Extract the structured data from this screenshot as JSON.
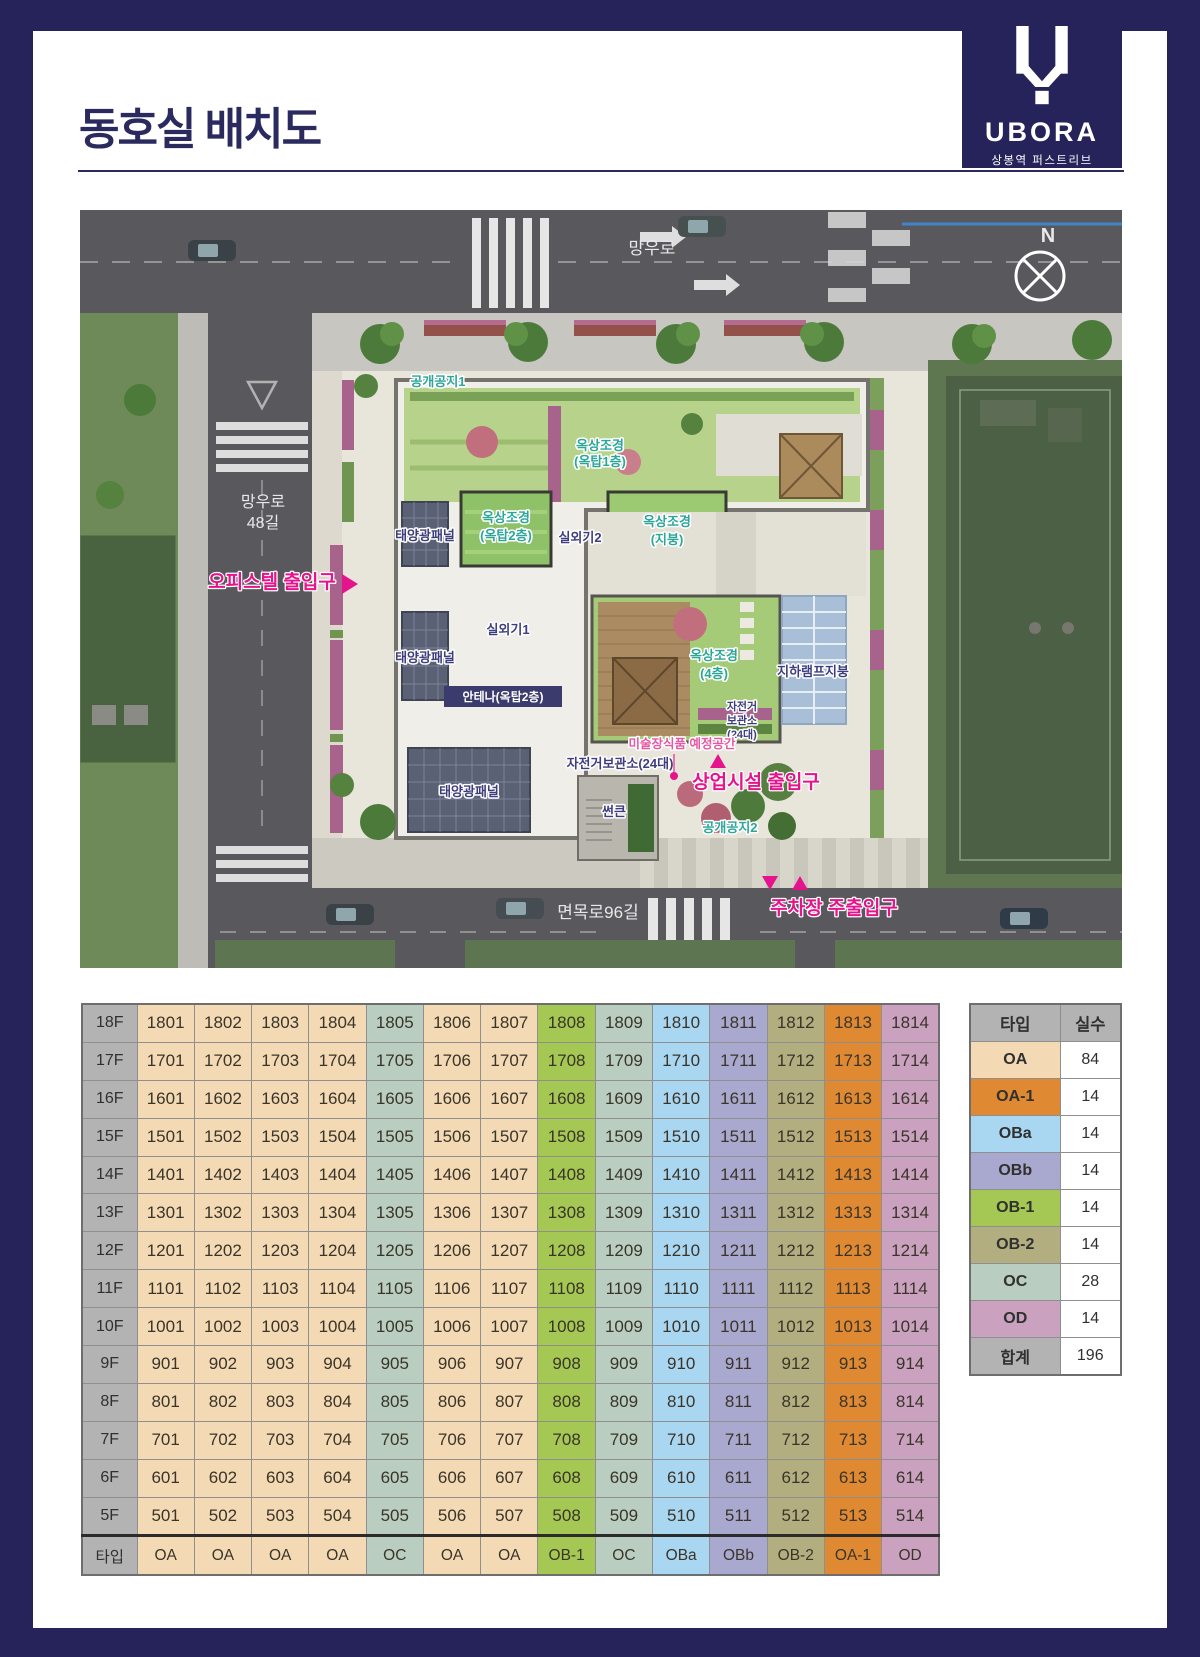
{
  "header": {
    "title": "동호실 배치도"
  },
  "logo": {
    "brand": "UBORA",
    "subtitle": "상봉역 퍼스트리브"
  },
  "map": {
    "road_top": "망우로",
    "road_left_1": "망우로",
    "road_left_2": "48길",
    "road_bottom": "면목로96길",
    "compass": "N",
    "labels": {
      "public1": "공개공지1",
      "roofgarden_top_l1": "옥상조경",
      "roofgarden_top_l2": "(옥탑1층)",
      "solar1": "태양광패널",
      "solar2": "태양광패널",
      "solar3": "태양광패널",
      "roofgarden2_l1": "옥상조경",
      "roofgarden2_l2": "(옥탑2층)",
      "ac2": "실외기2",
      "roofgarden_roof_l1": "옥상조경",
      "roofgarden_roof_l2": "(지붕)",
      "ac1": "실외기1",
      "antenna": "안테나(옥탑2층)",
      "roofgarden4_l1": "옥상조경",
      "roofgarden4_l2": "(4층)",
      "ramp_roof": "지하램프지붕",
      "art_space": "미술장식품 예정공간",
      "bike1": "자전거보관소(24대)",
      "bike2_l1": "자전거",
      "bike2_l2": "보관소",
      "bike2_l3": "(24대)",
      "sunken": "썬큰",
      "public2": "공개공지2",
      "entrance_officetel": "오피스텔 출입구",
      "entrance_retail": "상업시설 출입구",
      "entrance_parking": "주차장 주출입구"
    }
  },
  "table": {
    "type_header_label": "타입",
    "column_types": [
      "OA",
      "OA",
      "OA",
      "OA",
      "OC",
      "OA",
      "OA",
      "OB-1",
      "OC",
      "OBa",
      "OBb",
      "OB-2",
      "OA-1",
      "OD"
    ],
    "floors": [
      {
        "label": "18F",
        "units": [
          "1801",
          "1802",
          "1803",
          "1804",
          "1805",
          "1806",
          "1807",
          "1808",
          "1809",
          "1810",
          "1811",
          "1812",
          "1813",
          "1814"
        ]
      },
      {
        "label": "17F",
        "units": [
          "1701",
          "1702",
          "1703",
          "1704",
          "1705",
          "1706",
          "1707",
          "1708",
          "1709",
          "1710",
          "1711",
          "1712",
          "1713",
          "1714"
        ]
      },
      {
        "label": "16F",
        "units": [
          "1601",
          "1602",
          "1603",
          "1604",
          "1605",
          "1606",
          "1607",
          "1608",
          "1609",
          "1610",
          "1611",
          "1612",
          "1613",
          "1614"
        ]
      },
      {
        "label": "15F",
        "units": [
          "1501",
          "1502",
          "1503",
          "1504",
          "1505",
          "1506",
          "1507",
          "1508",
          "1509",
          "1510",
          "1511",
          "1512",
          "1513",
          "1514"
        ]
      },
      {
        "label": "14F",
        "units": [
          "1401",
          "1402",
          "1403",
          "1404",
          "1405",
          "1406",
          "1407",
          "1408",
          "1409",
          "1410",
          "1411",
          "1412",
          "1413",
          "1414"
        ]
      },
      {
        "label": "13F",
        "units": [
          "1301",
          "1302",
          "1303",
          "1304",
          "1305",
          "1306",
          "1307",
          "1308",
          "1309",
          "1310",
          "1311",
          "1312",
          "1313",
          "1314"
        ]
      },
      {
        "label": "12F",
        "units": [
          "1201",
          "1202",
          "1203",
          "1204",
          "1205",
          "1206",
          "1207",
          "1208",
          "1209",
          "1210",
          "1211",
          "1212",
          "1213",
          "1214"
        ]
      },
      {
        "label": "11F",
        "units": [
          "1101",
          "1102",
          "1103",
          "1104",
          "1105",
          "1106",
          "1107",
          "1108",
          "1109",
          "1110",
          "1111",
          "1112",
          "1113",
          "1114"
        ]
      },
      {
        "label": "10F",
        "units": [
          "1001",
          "1002",
          "1003",
          "1004",
          "1005",
          "1006",
          "1007",
          "1008",
          "1009",
          "1010",
          "1011",
          "1012",
          "1013",
          "1014"
        ]
      },
      {
        "label": "9F",
        "units": [
          "901",
          "902",
          "903",
          "904",
          "905",
          "906",
          "907",
          "908",
          "909",
          "910",
          "911",
          "912",
          "913",
          "914"
        ]
      },
      {
        "label": "8F",
        "units": [
          "801",
          "802",
          "803",
          "804",
          "805",
          "806",
          "807",
          "808",
          "809",
          "810",
          "811",
          "812",
          "813",
          "814"
        ]
      },
      {
        "label": "7F",
        "units": [
          "701",
          "702",
          "703",
          "704",
          "705",
          "706",
          "707",
          "708",
          "709",
          "710",
          "711",
          "712",
          "713",
          "714"
        ]
      },
      {
        "label": "6F",
        "units": [
          "601",
          "602",
          "603",
          "604",
          "605",
          "606",
          "607",
          "608",
          "609",
          "610",
          "611",
          "612",
          "613",
          "614"
        ]
      },
      {
        "label": "5F",
        "units": [
          "501",
          "502",
          "503",
          "504",
          "505",
          "506",
          "507",
          "508",
          "509",
          "510",
          "511",
          "512",
          "513",
          "514"
        ]
      }
    ]
  },
  "legend": {
    "headers": [
      "타입",
      "실수"
    ],
    "rows": [
      {
        "type": "OA",
        "count": "84"
      },
      {
        "type": "OA-1",
        "count": "14"
      },
      {
        "type": "OBa",
        "count": "14"
      },
      {
        "type": "OBb",
        "count": "14"
      },
      {
        "type": "OB-1",
        "count": "14"
      },
      {
        "type": "OB-2",
        "count": "14"
      },
      {
        "type": "OC",
        "count": "28"
      },
      {
        "type": "OD",
        "count": "14"
      },
      {
        "type": "합계",
        "count": "196"
      }
    ]
  },
  "colors": {
    "frame_navy": "#26225a",
    "title_navy": "#2b2a5e",
    "header_gray": "#b3b3b3",
    "types": {
      "OA": "#f3dab4",
      "OA-1": "#df8a33",
      "OBa": "#a9d7f2",
      "OBb": "#a9a8cf",
      "OB-1": "#a5c854",
      "OB-2": "#b2ae80",
      "OC": "#b9cec0",
      "OD": "#caa2c0"
    },
    "map_pink": "#e6148c",
    "map_teal": "#2ba699"
  }
}
